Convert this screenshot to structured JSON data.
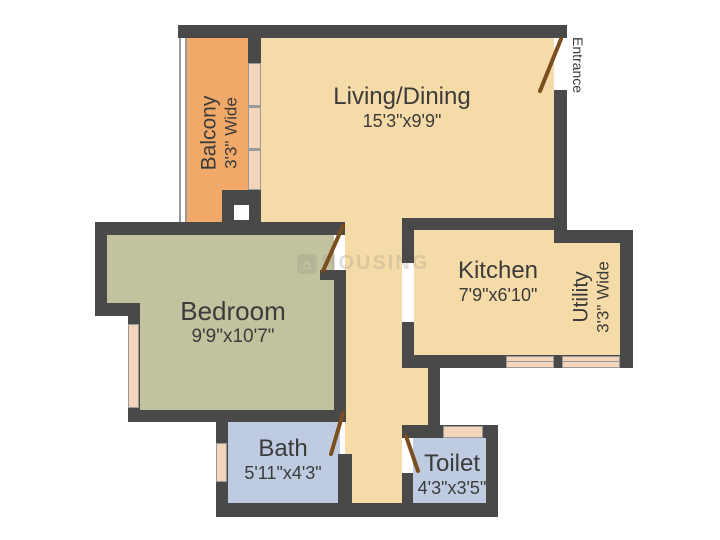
{
  "plan": {
    "watermark": "HOUSING",
    "entrance_label": "Entrance",
    "rooms": [
      {
        "id": "balcony",
        "name": "Balcony",
        "dims": "3'3\" Wide",
        "color": "#F0A968"
      },
      {
        "id": "living",
        "name": "Living/Dining",
        "dims": "15'3\"x9'9\"",
        "color": "#F5DBA7"
      },
      {
        "id": "bedroom",
        "name": "Bedroom",
        "dims": "9'9\"x10'7\"",
        "color": "#C2C39E"
      },
      {
        "id": "kitchen",
        "name": "Kitchen",
        "dims": "7'9\"x6'10\"",
        "color": "#F5DBA7"
      },
      {
        "id": "utility",
        "name": "Utility",
        "dims": "3'3\" Wide",
        "color": "#F5DBA7"
      },
      {
        "id": "bath",
        "name": "Bath",
        "dims": "5'11\"x4'3\"",
        "color": "#BFCBE1"
      },
      {
        "id": "toilet",
        "name": "Toilet",
        "dims": "4'3\"x3'5\"",
        "color": "#BFCBE1"
      }
    ],
    "colors": {
      "wall": "#494949",
      "floor": "#F5DBA7",
      "balcony": "#F0A968",
      "bedroom": "#C2C39E",
      "bathroom": "#BFCBE1",
      "window": "#F3D5BB",
      "door": "#7B4E1F",
      "label": "#3B3B3B",
      "background": "#FFFFFF"
    }
  }
}
